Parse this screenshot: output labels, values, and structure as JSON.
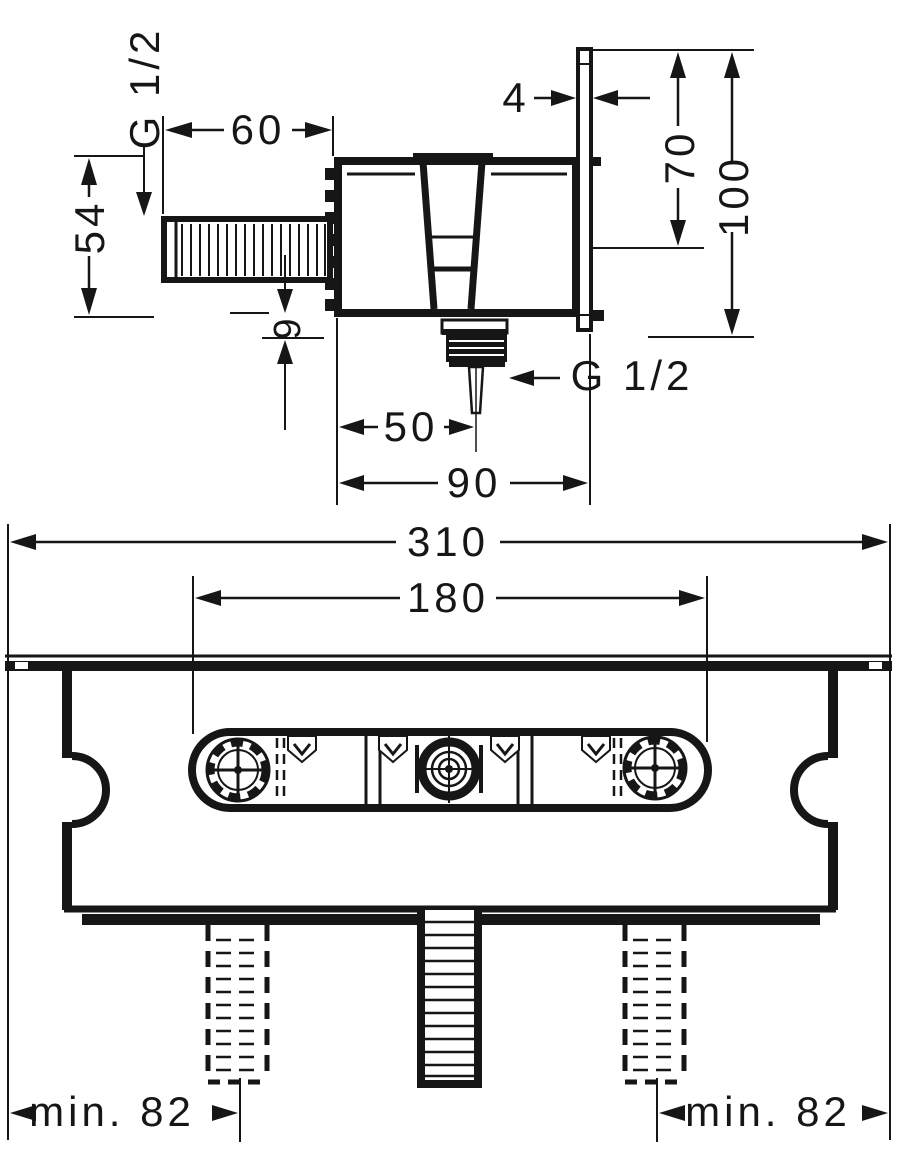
{
  "palette": {
    "line": "#161616",
    "background": "#ffffff"
  },
  "side_view": {
    "g12_inlet": "G 1/2",
    "len_60": "60",
    "h_54": "54",
    "off_9": "9",
    "plate_4": "4",
    "drop_70": "70",
    "height_100": "100",
    "g12_outlet": "G 1/2",
    "off_50": "50",
    "depth_90": "90"
  },
  "top_view": {
    "width_310": "310",
    "slot_180": "180",
    "min82_left": "min. 82",
    "min82_right": "min. 82"
  }
}
